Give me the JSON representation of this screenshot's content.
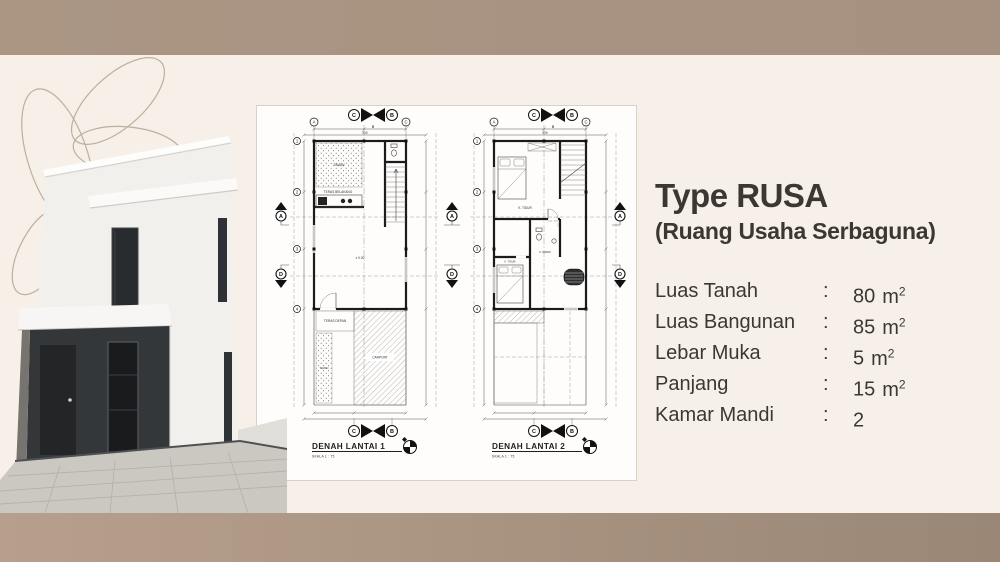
{
  "info_panel": {
    "title": "Type RUSA",
    "subtitle": "(Ruang Usaha Serbaguna)",
    "specs": [
      {
        "label": "Luas Tanah",
        "colon": ":",
        "value": "80",
        "unit": "m",
        "sup": "2"
      },
      {
        "label": "Luas Bangunan",
        "colon": ":",
        "value": "85",
        "unit": "m",
        "sup": "2"
      },
      {
        "label": "Lebar Muka",
        "colon": ":",
        "value": "5",
        "unit": "m",
        "sup": "2"
      },
      {
        "label": "Panjang",
        "colon": ":",
        "value": "15",
        "unit": "m",
        "sup": "2"
      },
      {
        "label": "Kamar Mandi",
        "colon": ":",
        "value": "2",
        "unit": "",
        "sup": ""
      }
    ]
  },
  "plans": {
    "grid": {
      "a": "A",
      "b": "B",
      "c": "C"
    },
    "rows": [
      "1",
      "2",
      "3",
      "4"
    ],
    "cut": {
      "left": "C",
      "right": "B",
      "sub": "B"
    },
    "side": {
      "up": "A",
      "down": "D"
    },
    "dims": {
      "total": "500"
    },
    "plan1": {
      "title": "DENAH LANTAI 1",
      "scale": "SKALA 1 : 75",
      "labels": {
        "taman_back": "TAMAN",
        "teras_belakang": "TERAS BELAKANG",
        "level": "± 0.00",
        "teras_depan": "TERAS DEPAN",
        "taman_front": "TAMAN",
        "carport": "CARPORT"
      }
    },
    "plan2": {
      "title": "DENAH LANTAI 2",
      "scale": "SKALA 1 : 75",
      "labels": {
        "bedroom1": "K. TIDUR",
        "bath": "K. MANDI",
        "bedroom2": "K. TIDUR"
      }
    }
  }
}
